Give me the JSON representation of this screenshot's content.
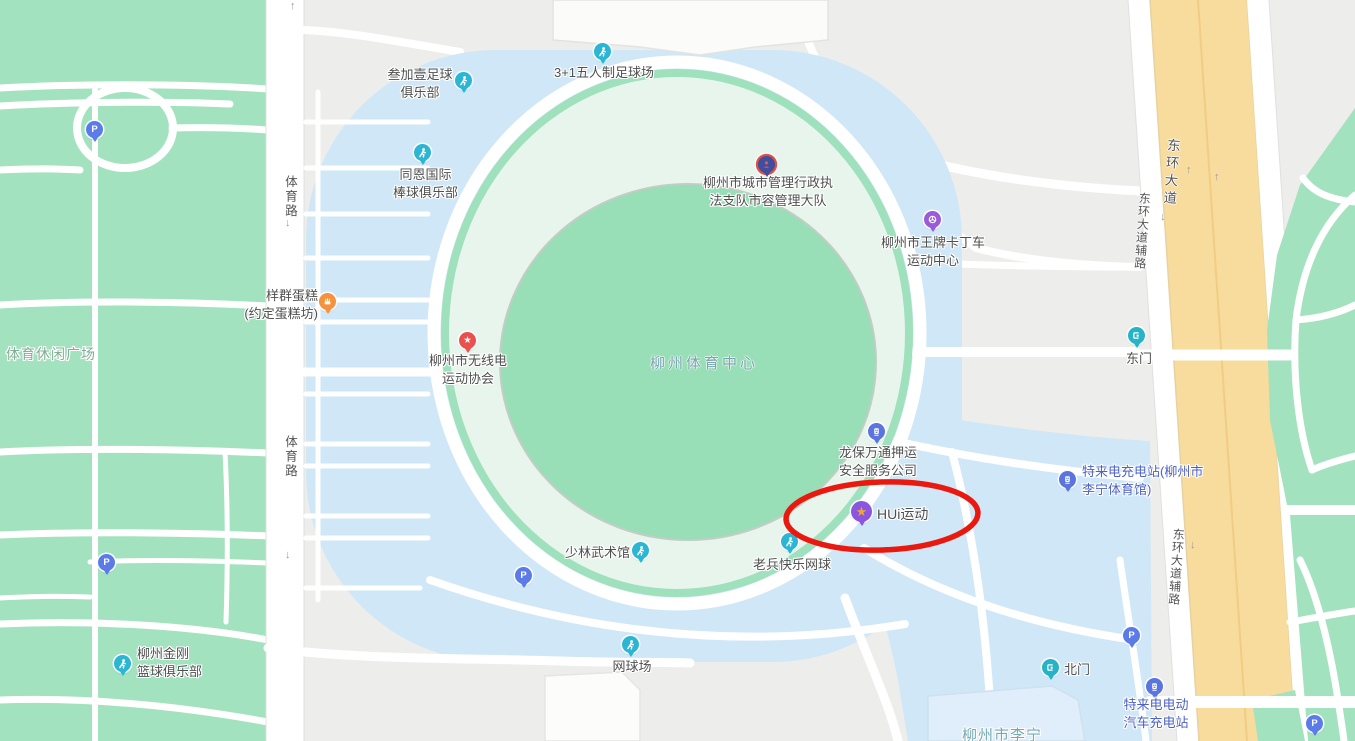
{
  "map_name": "Liuzhou Sports Center map",
  "areas": {
    "leisure_square": "体育休闲广场",
    "sports_center": "柳州体育中心"
  },
  "roads": {
    "tiyu_road": "体育路",
    "donghuan_avenue": "东环大道",
    "donghuan_service_road": "东环大道辅路"
  },
  "arrows": {
    "up": "↑",
    "down": "↓"
  },
  "pois": {
    "sanjiayi": {
      "l1": "叁加壹足球",
      "l2": "俱乐部"
    },
    "wurenzhi": {
      "l1": "3+1五人制足球场"
    },
    "tongen": {
      "l1": "同恩国际",
      "l2": "棒球俱乐部"
    },
    "yangqun": {
      "l1": "样群蛋糕",
      "l2": "(约定蛋糕坊)"
    },
    "wuxiandian": {
      "l1": "柳州市无线电",
      "l2": "运动协会"
    },
    "chengguan": {
      "l1": "柳州市城市管理行政执",
      "l2": "法支队市容管理大队"
    },
    "kading": {
      "l1": "柳州市王牌卡丁车",
      "l2": "运动中心"
    },
    "longbao": {
      "l1": "龙保万通押运",
      "l2": "安全服务公司"
    },
    "hui": {
      "l1": "HUi运动"
    },
    "telai_east": {
      "l1": "特来电充电站(柳州市",
      "l2": "李宁体育馆)"
    },
    "shaolin": {
      "l1": "少林武术馆"
    },
    "laobing": {
      "l1": "老兵快乐网球"
    },
    "wangqiuchang": {
      "l1": "网球场"
    },
    "jingang": {
      "l1": "柳州金刚",
      "l2": "篮球俱乐部"
    },
    "telai_south": {
      "l1": "特来电电动",
      "l2": "汽车充电站"
    },
    "dongmen": {
      "l1": "东门"
    },
    "beimen": {
      "l1": "北门"
    },
    "lining": {
      "l1": "柳州市李宁"
    }
  },
  "icons": {
    "parking": "P",
    "star": "★"
  },
  "palette": {
    "background": "#ededeb",
    "park_green": "#a2e2bf",
    "stadium_pale": "#e8f5ed",
    "stadium_inner": "#98deb6",
    "parking_blue": "#cfe7f6",
    "road_yellow": "#f8dc9d",
    "annotation_red": "#e9190f",
    "sports_pin": "#2bb6d4",
    "purple_pin": "#9a5cd8",
    "hui_pin_purple": "#8a56e0",
    "charge_pin_blue": "#5a74e0",
    "parking_pin_blue": "#5b7be8",
    "star_pin_red": "#e8514d",
    "cake_pin_orange": "#f6913e"
  }
}
